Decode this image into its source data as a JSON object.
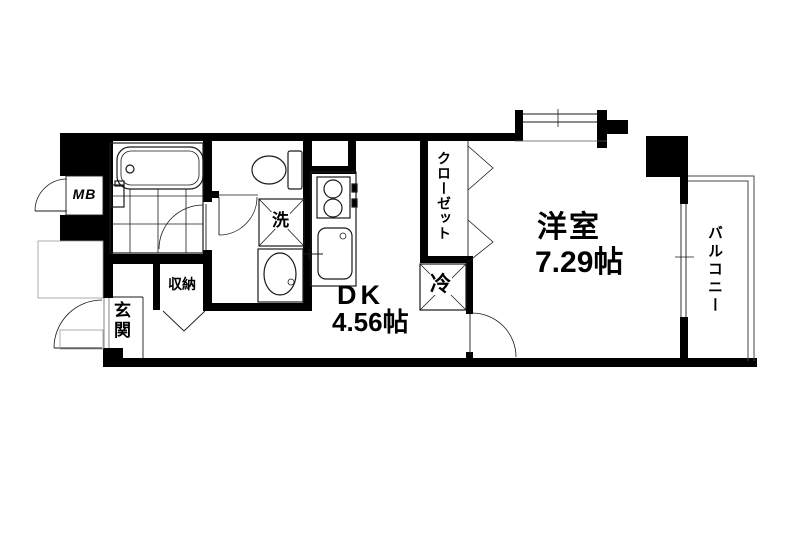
{
  "title": "apartment-floor-plan",
  "colors": {
    "wall": "#000000",
    "line": "#1a1a1a",
    "background": "#ffffff"
  },
  "labels": {
    "meter_box": "MB",
    "entrance": "玄関",
    "storage": "収納",
    "washing_machine": "洗",
    "refrigerator": "冷",
    "closet": "クローゼット",
    "dk_name": "DK",
    "dk_area": "4.56帖",
    "western_room_name": "洋室",
    "western_room_area": "7.29帖",
    "balcony": "バルコニー"
  },
  "rooms": [
    {
      "name": "DK",
      "area_jo": 4.56
    },
    {
      "name": "洋室",
      "area_jo": 7.29
    },
    {
      "name": "玄関"
    },
    {
      "name": "収納"
    },
    {
      "name": "クローゼット"
    },
    {
      "name": "バルコニー"
    },
    {
      "name": "MB"
    }
  ]
}
